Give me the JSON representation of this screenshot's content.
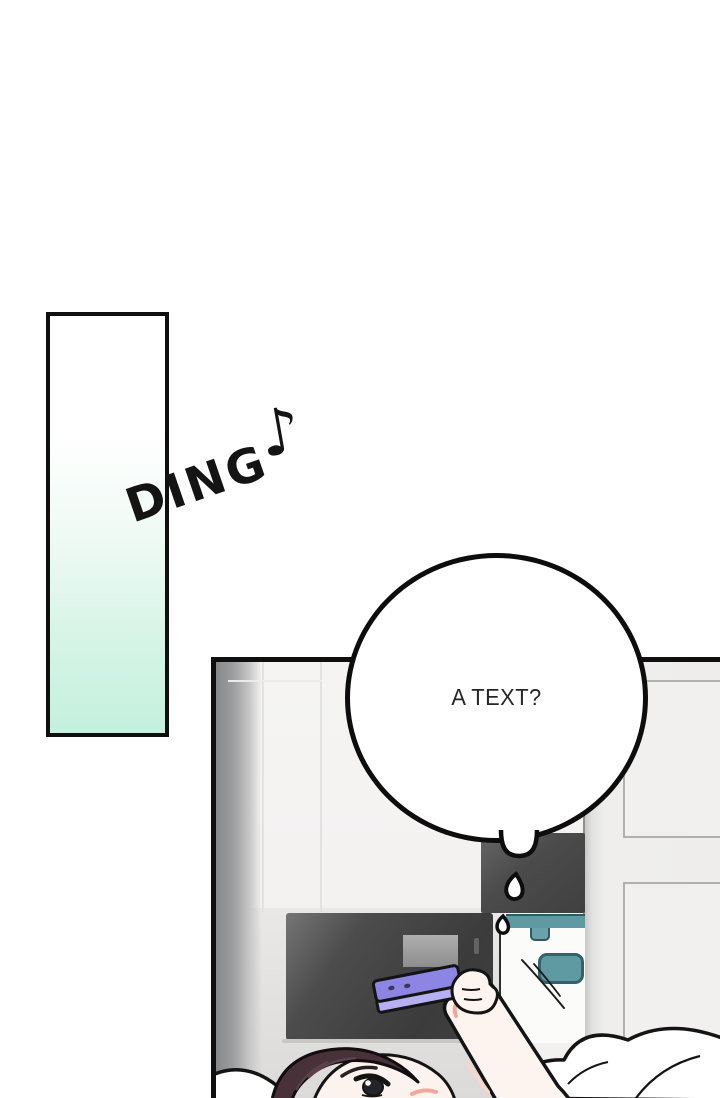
{
  "sfx_ding": {
    "text": "DING",
    "note_glyph": "♪"
  },
  "speech_bubble": {
    "text": "A TEXT?"
  },
  "scene": {
    "description_names": [
      "mint-flash-panel",
      "bedroom-wall",
      "wardrobe-doors",
      "closet-door-panels",
      "dark-cabinet",
      "dark-media-box",
      "teal-appliance",
      "sweat-drops",
      "speech-bubble-tail",
      "person-head",
      "arm",
      "hand",
      "purple-smartphone",
      "pillow",
      "blanket"
    ],
    "colors": {
      "mint_bottom": "#c4f0de",
      "outline_black": "#0f0f0f",
      "phone_top": "#8c85e4",
      "phone_side": "#b6b0f2",
      "teal_accent": "#5f9aa3",
      "teal_outline": "#35626a",
      "cabinet_dark": "#3f3f3f",
      "wall_light": "#f3f2f1",
      "hair_dark_plum": "#483139",
      "skin_pale": "#fdf3ee",
      "blush_pink": "#f0a79c"
    }
  }
}
